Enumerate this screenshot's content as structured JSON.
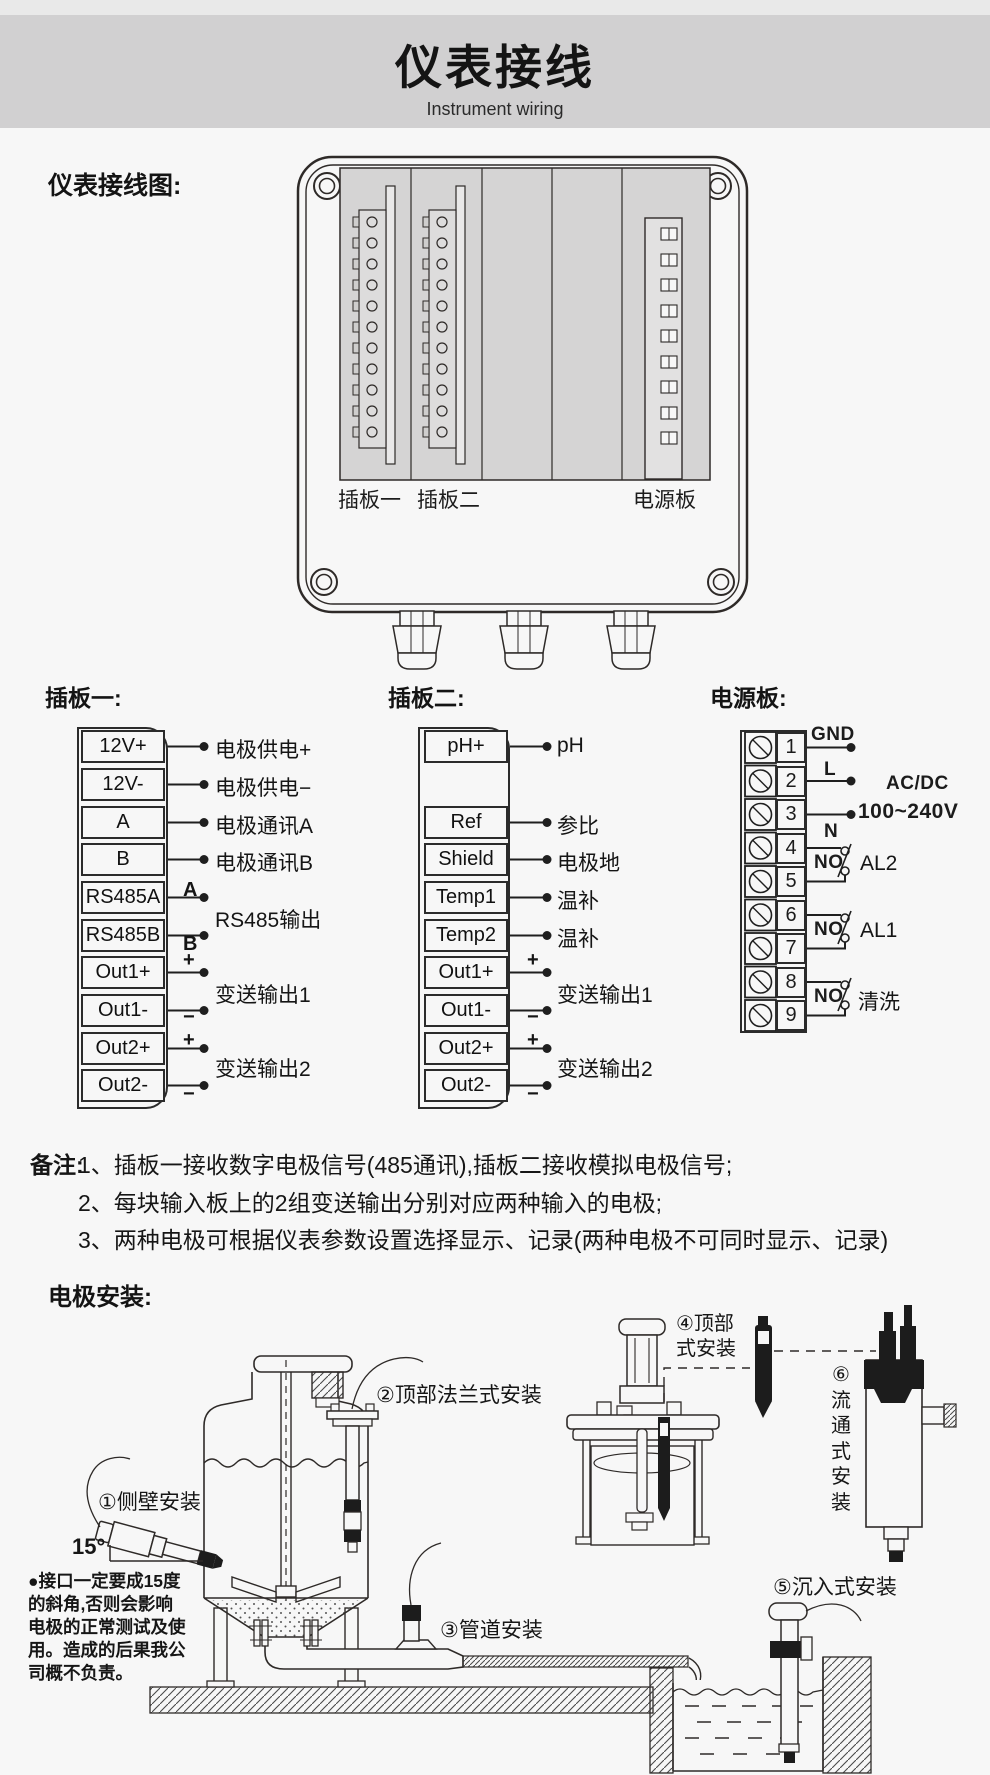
{
  "header": {
    "title": "仪表接线",
    "subtitle": "Instrument wiring"
  },
  "diagram": {
    "section_label": "仪表接线图:",
    "slot1": "插板一",
    "slot2": "插板二",
    "power": "电源板"
  },
  "board1": {
    "title": "插板一:",
    "terminals": [
      "12V+",
      "12V-",
      "A",
      "B",
      "RS485A",
      "RS485B",
      "Out1+",
      "Out1-",
      "Out2+",
      "Out2-"
    ],
    "wire_labels": [
      "电极供电+",
      "电极供电−",
      "电极通讯A",
      "电极通讯B",
      "RS485输出",
      "变送输出1",
      "变送输出2"
    ],
    "marks": {
      "a": "A",
      "b": "B",
      "plus": "+",
      "minus": "−"
    }
  },
  "board2": {
    "title": "插板二:",
    "terminals": [
      "pH+",
      "Ref",
      "Shield",
      "Temp1",
      "Temp2",
      "Out1+",
      "Out1-",
      "Out2+",
      "Out2-"
    ],
    "wire_labels": [
      "pH",
      "参比",
      "电极地",
      "温补",
      "温补",
      "变送输出1",
      "变送输出2"
    ],
    "marks": {
      "plus": "+",
      "minus": "−"
    }
  },
  "power": {
    "title": "电源板:",
    "terminals": [
      "1",
      "2",
      "3",
      "4",
      "5",
      "6",
      "7",
      "8",
      "9"
    ],
    "gnd": "GND",
    "l": "L",
    "n": "N",
    "acdc": "AC/DC",
    "range": "100~240V",
    "relays": [
      {
        "no": "NO",
        "label": "AL2"
      },
      {
        "no": "NO",
        "label": "AL1"
      },
      {
        "no": "NO",
        "label": "清洗"
      }
    ]
  },
  "notes": {
    "title": "备注:",
    "items": [
      "1、插板一接收数字电极信号(485通讯),插板二接收模拟电极信号;",
      "2、每块输入板上的2组变送输出分别对应两种输入的电极;",
      "3、两种电极可根据仪表参数设置选择显示、记录(两种电极不可同时显示、记录)"
    ]
  },
  "install": {
    "title": "电极安装:",
    "side": "①侧壁安装",
    "top_flange": "②顶部法兰式安装",
    "pipe": "③管道安装",
    "top_mount": "④顶部\n式安装",
    "submersion": "⑤沉入式安装",
    "flow": "⑥流通式安装",
    "angle": "15°",
    "warning": "●接口一定要成15度\n的斜角,否则会影响\n电极的正常测试及使\n用。造成的后果我公\n司概不负责。"
  },
  "colors": {
    "header_band": "#d1d0d1",
    "panel": "#d5d4d4",
    "ink": "#2b2b2b",
    "background": "#f7f7f7"
  }
}
